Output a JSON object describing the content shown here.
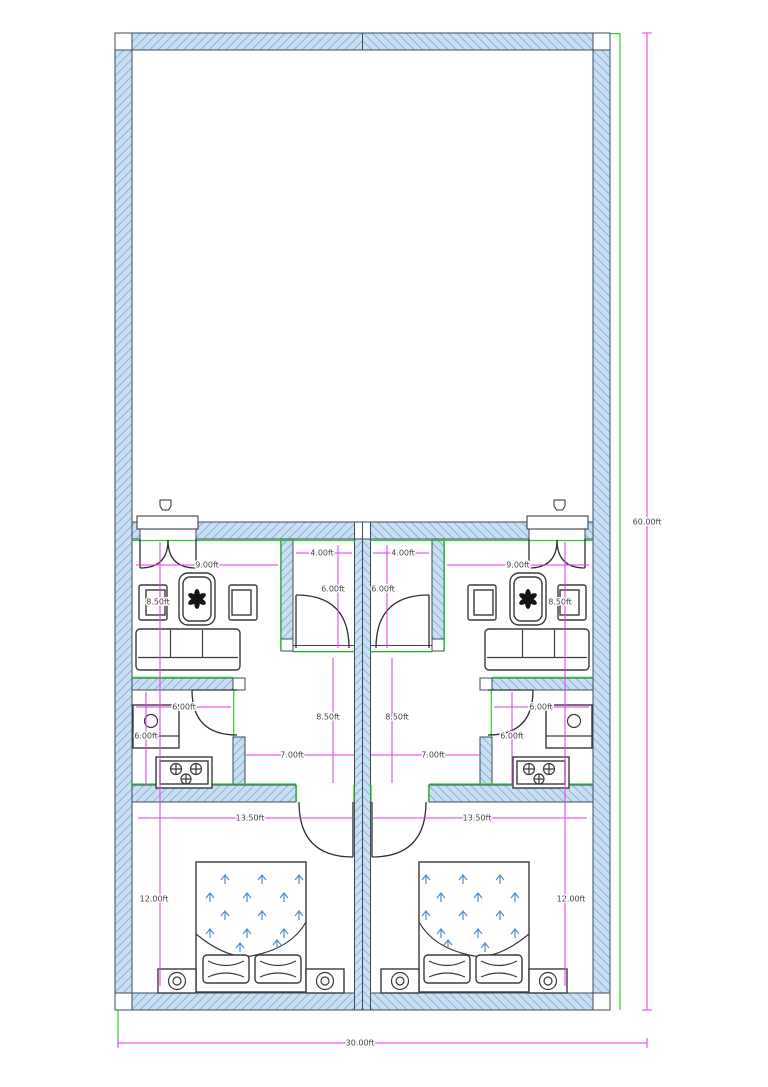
{
  "dimensions": {
    "building_depth": "60.00ft",
    "building_width": "30.00ft",
    "living_width": "9.00ft",
    "living_depth": "8.50ft",
    "closet_width": "4.00ft",
    "closet_depth": "6.00ft",
    "kitchen_width": "6.00ft",
    "kitchen_depth": "6.00ft",
    "hall_depth": "8.50ft",
    "hall_width": "7.00ft",
    "bedroom_width": "13.50ft",
    "bedroom_depth": "12.00ft"
  },
  "colors": {
    "wall_fill": "#c9dff3",
    "wall_hatch": "#8db3d6",
    "wall_outline": "#3d4a57",
    "dimension_line": "#e936e9",
    "reference_line": "#2ad12a",
    "furniture_outline": "#3a3a3a",
    "blanket_arrows": "#4e8fce"
  }
}
